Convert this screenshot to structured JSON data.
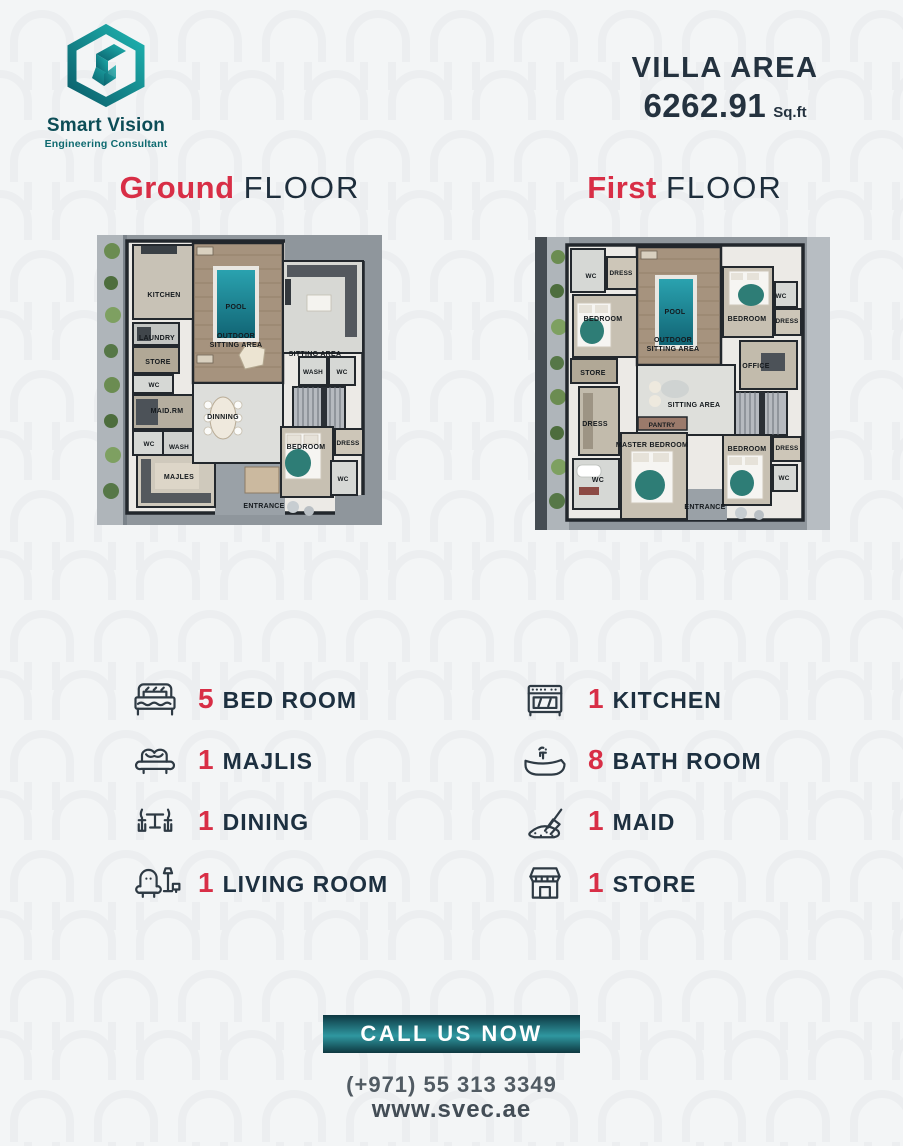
{
  "colors": {
    "accent_red": "#d82e46",
    "navy": "#1d3040",
    "teal_dark": "#0e3840",
    "teal": "#2f97a0",
    "logo_teal": "#14919b",
    "pool": "#1c8896",
    "background": "#f3f5f6"
  },
  "brand": {
    "name": "Smart Vision",
    "tagline": "Engineering Consultant"
  },
  "header": {
    "area_label": "VILLA AREA",
    "area_value": "6262.91",
    "area_unit": "Sq.ft"
  },
  "floor_titles": {
    "ground": {
      "accent": "Ground",
      "rest": "FLOOR"
    },
    "first": {
      "accent": "First",
      "rest": "FLOOR"
    }
  },
  "plans": {
    "ground": {
      "rooms": {
        "kitchen": "KITCHEN",
        "laundry": "LAUNDRY",
        "store": "STORE",
        "wc_a": "WC",
        "maid": "MAID.RM",
        "wc_b": "WC",
        "wash_a": "WASH",
        "majles": "MAJLES",
        "pool": "POOL",
        "outdoor1": "OUTDOOR",
        "outdoor2": "SITTING AREA",
        "sitting": "SITTING AREA",
        "wash_b": "WASH",
        "wc_c": "WC",
        "dinning": "DINNING",
        "bedroom": "BEDROOM",
        "dress": "DRESS",
        "wc_d": "WC",
        "entrance": "ENTRANCE"
      }
    },
    "first": {
      "rooms": {
        "wc_a": "WC",
        "dress_a": "DRESS",
        "bedroom_a": "BEDROOM",
        "store": "STORE",
        "dress_b": "DRESS",
        "wc_b": "WC",
        "pool": "POOL",
        "outdoor1": "OUTDOOR",
        "outdoor2": "SITTING AREA",
        "bedroom_b": "BEDROOM",
        "wc_c": "WC",
        "dress_c": "DRESS",
        "office": "OFFICE",
        "sitting": "SITTING AREA",
        "pantry": "PANTRY",
        "master": "MASTER BEDROOM",
        "bedroom_c": "BEDROOM",
        "dress_d": "DRESS",
        "wc_d": "WC",
        "entrance": "ENTRANCE"
      }
    }
  },
  "features": {
    "left": [
      {
        "icon": "bed-icon",
        "count": "5",
        "label": "BED ROOM"
      },
      {
        "icon": "sofa-icon",
        "count": "1",
        "label": "MAJLIS"
      },
      {
        "icon": "dining-icon",
        "count": "1",
        "label": "DINING"
      },
      {
        "icon": "armchair-icon",
        "count": "1",
        "label": "LIVING ROOM"
      }
    ],
    "right": [
      {
        "icon": "stove-icon",
        "count": "1",
        "label": "KITCHEN"
      },
      {
        "icon": "bathtub-icon",
        "count": "8",
        "label": "BATH ROOM"
      },
      {
        "icon": "mop-icon",
        "count": "1",
        "label": "MAID"
      },
      {
        "icon": "store-icon",
        "count": "1",
        "label": "STORE"
      }
    ]
  },
  "cta": {
    "button_label": "CALL US NOW",
    "phone": "(+971) 55 313 3349",
    "website": "www.svec.ae"
  }
}
